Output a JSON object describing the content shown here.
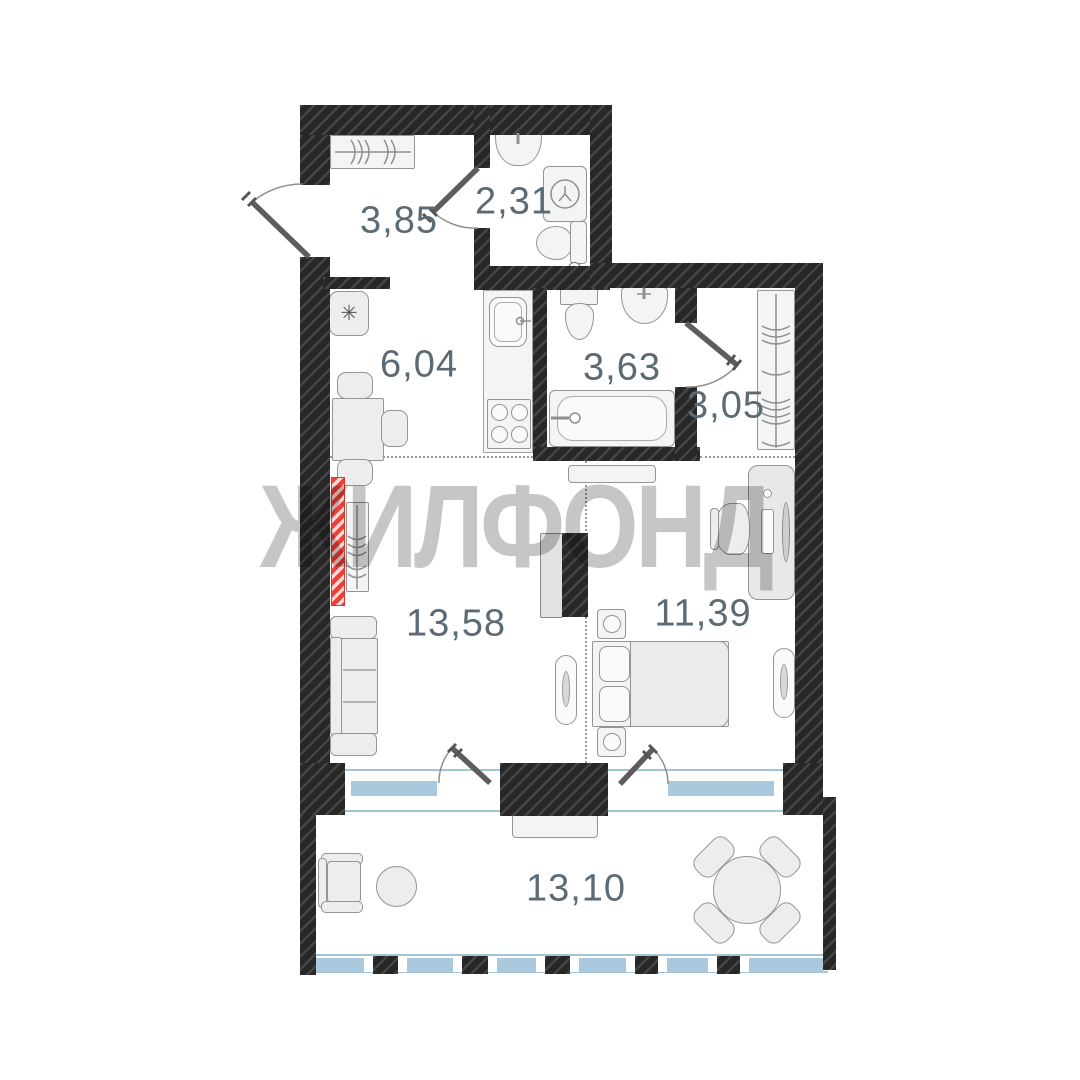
{
  "watermark": {
    "text": "ЖИЛФОНД",
    "color": "#c6c6c6"
  },
  "rooms": {
    "hallway": {
      "area": "3,85"
    },
    "wc": {
      "area": "2,31"
    },
    "kitchen": {
      "area": "6,04"
    },
    "bathroom": {
      "area": "3,63"
    },
    "wardrobe": {
      "area": "3,05"
    },
    "living_room": {
      "area": "13,58"
    },
    "bedroom": {
      "area": "11,39"
    },
    "balcony": {
      "area": "13,10"
    }
  },
  "icons": {
    "fridge_glyph": "✳"
  },
  "colors": {
    "wall": "#272727",
    "window": "#aac9dd",
    "radiator": "#ef3f36",
    "label_text": "#5c6a74",
    "watermark": "#c6c6c6",
    "furniture_fill": "#ededed",
    "furniture_border": "#949494"
  }
}
